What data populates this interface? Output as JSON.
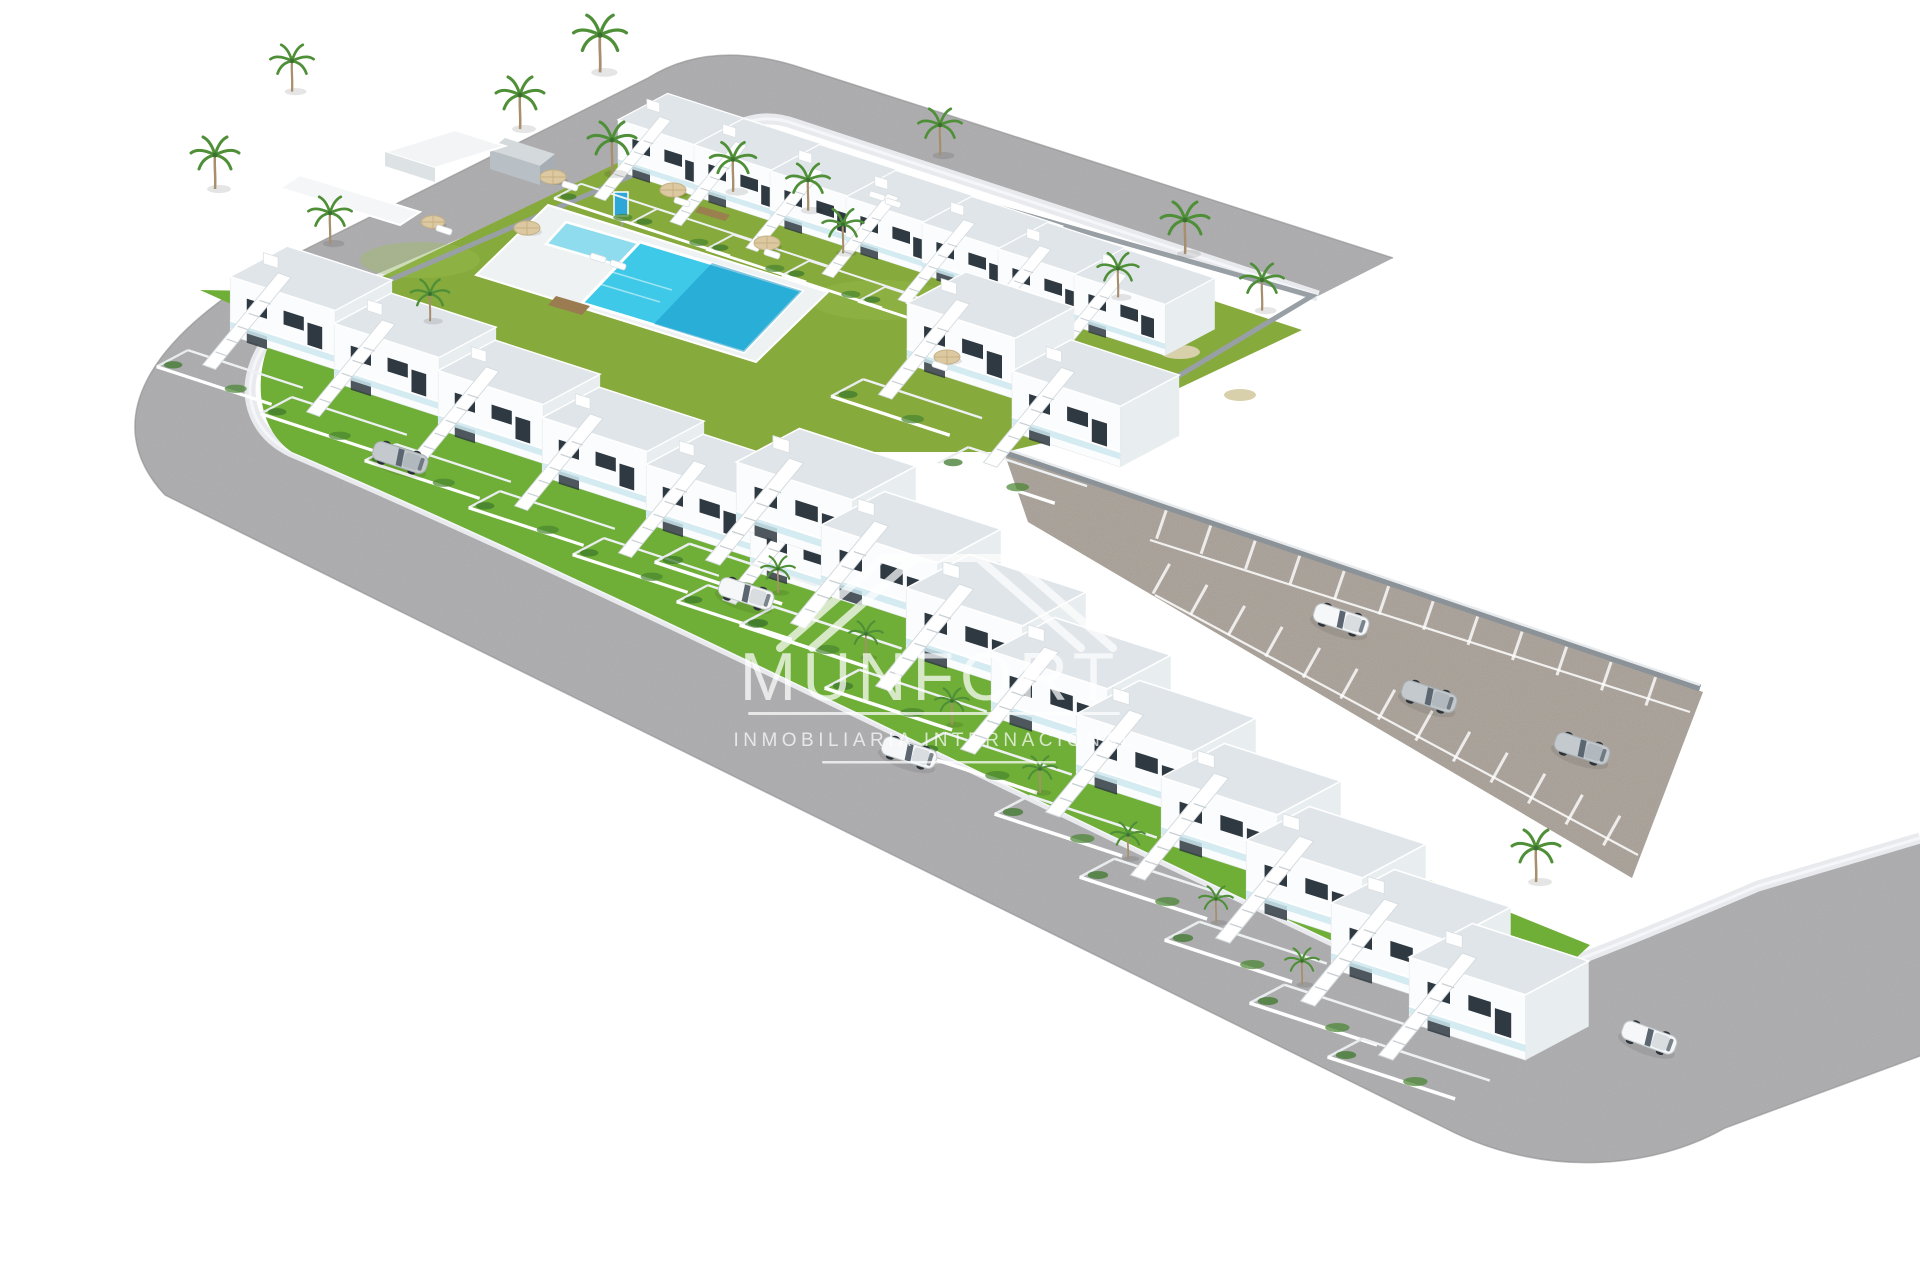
{
  "watermark": {
    "brand": "MUNFORT",
    "tagline": "INMOBILIARIA INTERNACIONAL"
  },
  "colors": {
    "background": "#ffffff",
    "road": "#a8a8aa",
    "road_edge": "#8e8e90",
    "parking_road": "#a49b91",
    "sidewalk": "#e9eaee",
    "grass_communal": "#87aa3c",
    "grass_private": "#6fae37",
    "grass_light": "#9cbf52",
    "pool_deck": "#eff2f3",
    "pool_water": "#3ec9e8",
    "pool_water_deep": "#1898c8",
    "house_white": "#fbfcfd",
    "house_shade": "#e8edf0",
    "roof": "#e0e5e9",
    "window": "#2f3941",
    "wall_gray": "#98a0a6",
    "wall_dark": "#8b9298",
    "palm_green": "#4f8f38",
    "palm_trunk": "#a78f6d",
    "parasol_tan": "#dcc9a2",
    "step_brown": "#9b7b50",
    "gravel": "#d8cfab",
    "car_white": "#f5f7f8",
    "car_silver": "#c3c9cd",
    "car_glass": "#5b6671",
    "watermark": "#ffffff"
  },
  "scene": {
    "type": "3d-aerial-render",
    "subject": "New-build residential development of white two-storey townhouses with communal pool, gardens, perimeter roads and parking lane",
    "features": {
      "communal_pools": 2,
      "top_row_houses": 7,
      "bottom_row_houses": 6,
      "corner_houses": 2,
      "terrace_row_houses": 9,
      "cars_on_roads": 7,
      "parking_lane": 1
    },
    "instances": {
      "houses_top_row": [
        [
          570,
          75,
          0.8
        ],
        [
          646,
          100,
          0.8
        ],
        [
          722,
          126,
          0.8
        ],
        [
          798,
          152,
          0.8
        ],
        [
          874,
          178,
          0.8
        ],
        [
          950,
          204,
          0.8
        ],
        [
          1026,
          230,
          0.8
        ]
      ],
      "houses_bottom_row": [
        [
          175,
          225,
          0.92
        ],
        [
          279,
          272,
          0.92
        ],
        [
          383,
          319,
          0.92
        ],
        [
          487,
          366,
          0.92
        ],
        [
          591,
          413,
          0.92
        ],
        [
          695,
          460,
          0.92
        ]
      ],
      "corner_houses": [
        [
          850,
          250,
          0.95
        ],
        [
          955,
          318,
          0.95
        ]
      ],
      "terrace_row": [
        [
          675,
          405,
          1.02
        ],
        [
          760,
          468,
          1.02
        ],
        [
          845,
          531,
          1.02
        ],
        [
          930,
          594,
          1.02
        ],
        [
          1015,
          657,
          1.02
        ],
        [
          1100,
          720,
          1.02
        ],
        [
          1185,
          783,
          1.02
        ],
        [
          1270,
          846,
          1.02
        ],
        [
          1348,
          900,
          1.02
        ]
      ],
      "palms": [
        [
          215,
          185,
          1
        ],
        [
          330,
          240,
          0.9
        ],
        [
          600,
          68,
          1.1
        ],
        [
          520,
          125,
          1
        ],
        [
          612,
          170,
          1
        ],
        [
          733,
          188,
          0.95
        ],
        [
          808,
          207,
          0.9
        ],
        [
          843,
          250,
          0.85
        ],
        [
          940,
          152,
          0.9
        ],
        [
          1185,
          250,
          1
        ],
        [
          1262,
          307,
          0.9
        ],
        [
          1118,
          294,
          0.85
        ],
        [
          430,
          318,
          0.8
        ],
        [
          292,
          88,
          0.9
        ],
        [
          778,
          590,
          0.7
        ],
        [
          866,
          655,
          0.7
        ],
        [
          952,
          722,
          0.7
        ],
        [
          1040,
          790,
          0.7
        ],
        [
          1128,
          856,
          0.7
        ],
        [
          1216,
          920,
          0.7
        ],
        [
          1302,
          982,
          0.7
        ],
        [
          1536,
          878,
          1
        ]
      ],
      "parasols": [
        [
          553,
          177,
          1
        ],
        [
          673,
          190,
          1
        ],
        [
          527,
          228,
          1
        ],
        [
          767,
          243,
          1
        ],
        [
          947,
          357,
          1
        ],
        [
          433,
          222,
          0.9
        ]
      ],
      "loungers": [
        [
          570,
          186,
          1
        ],
        [
          682,
          202,
          1
        ],
        [
          772,
          254,
          1
        ],
        [
          940,
          366,
          1
        ],
        [
          444,
          230,
          1
        ],
        [
          598,
          258,
          1
        ],
        [
          618,
          265,
          1
        ],
        [
          877,
          196,
          1
        ],
        [
          893,
          203,
          1
        ]
      ],
      "cars": [
        {
          "x": 400,
          "y": 458,
          "symbol": "sym-car-silver",
          "rot": 18
        },
        {
          "x": 746,
          "y": 594,
          "symbol": "sym-car-white",
          "rot": 18
        },
        {
          "x": 909,
          "y": 753,
          "symbol": "sym-car-white",
          "rot": 18
        },
        {
          "x": 1341,
          "y": 620,
          "symbol": "sym-car-white",
          "rot": 18
        },
        {
          "x": 1429,
          "y": 697,
          "symbol": "sym-car-silver",
          "rot": 18
        },
        {
          "x": 1582,
          "y": 749,
          "symbol": "sym-car-silver",
          "rot": 18
        },
        {
          "x": 1649,
          "y": 1038,
          "symbol": "sym-car-white",
          "rot": 20
        }
      ]
    }
  }
}
